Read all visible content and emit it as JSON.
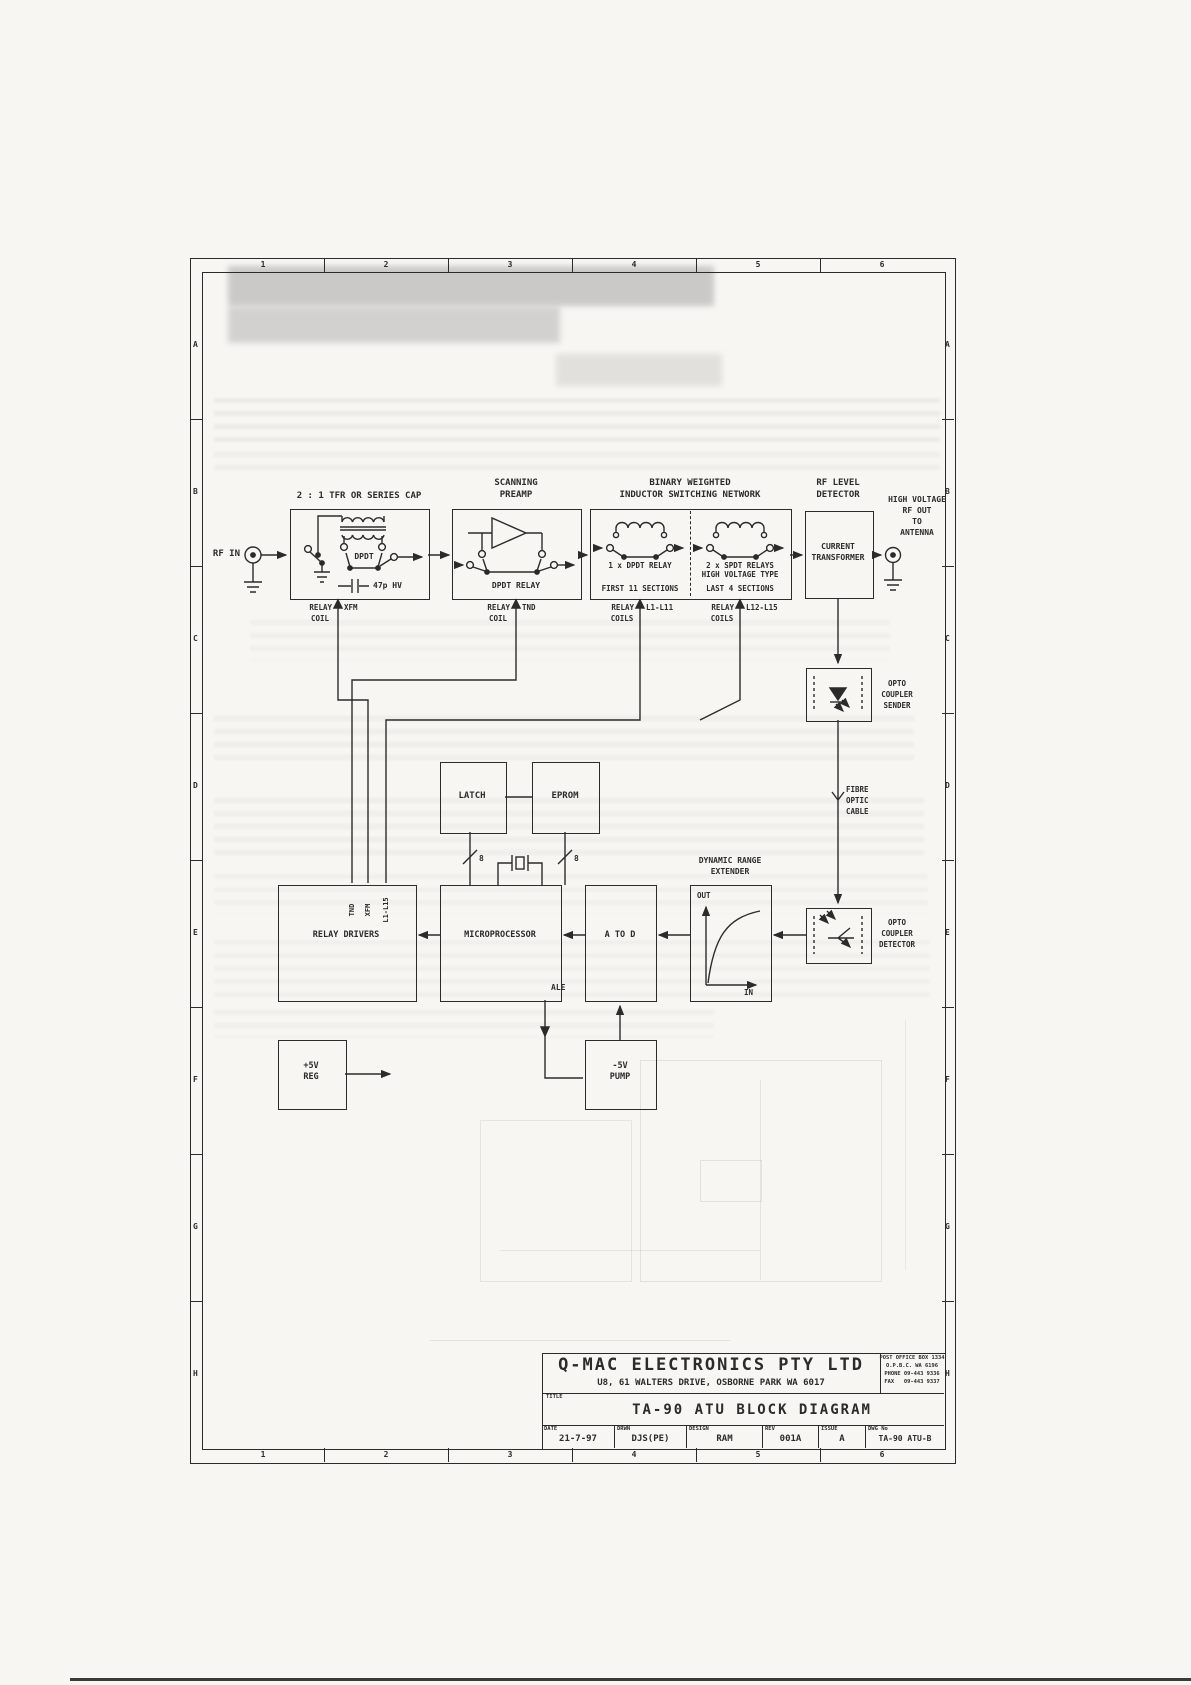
{
  "colors": {
    "ink": "#2b2b2b",
    "paper": "#f7f6f2"
  },
  "frame": {
    "columns": [
      "1",
      "2",
      "3",
      "4",
      "5",
      "6"
    ],
    "rows": [
      "A",
      "B",
      "C",
      "D",
      "E",
      "F",
      "G",
      "H"
    ]
  },
  "diagram": {
    "rf_in_label": "RF IN",
    "input_stage": {
      "title": "2 : 1 TFR OR SERIES CAP",
      "switch_label": "DPDT",
      "cap_label": "47p HV"
    },
    "preamp": {
      "title1": "SCANNING",
      "title2": "PREAMP",
      "relay_label": "DPDT RELAY"
    },
    "network": {
      "title1": "BINARY WEIGHTED",
      "title2": "INDUCTOR SWITCHING NETWORK",
      "left_relay": "1 x DPDT RELAY",
      "left_sections": "FIRST 11 SECTIONS",
      "right_relay1": "2 x SPDT RELAYS",
      "right_relay2": "HIGH VOLTAGE TYPE",
      "right_sections": "LAST 4 SECTIONS"
    },
    "detector_block": {
      "title1": "RF LEVEL",
      "title2": "DETECTOR",
      "inner1": "CURRENT",
      "inner2": "TRANSFORMER"
    },
    "rf_out": {
      "line1": "HIGH VOLTAGE",
      "line2": "RF OUT",
      "line3": "TO",
      "line4": "ANTENNA"
    },
    "coils": {
      "xfm": {
        "relay": "RELAY",
        "name": "XFM",
        "coil": "COIL"
      },
      "tnd": {
        "relay": "RELAY",
        "name": "TND",
        "coil": "COIL"
      },
      "l1": {
        "relay": "RELAY",
        "name": "L1-L11",
        "coil": "COILS"
      },
      "l12": {
        "relay": "RELAY",
        "name": "L12-L15",
        "coil": "COILS"
      }
    },
    "opto_sender": {
      "l1": "OPTO",
      "l2": "COUPLER",
      "l3": "SENDER"
    },
    "fibre": {
      "l1": "FIBRE",
      "l2": "OPTIC",
      "l3": "CABLE"
    },
    "opto_detector": {
      "l1": "OPTO",
      "l2": "COUPLER",
      "l3": "DETECTOR"
    },
    "latch_label": "LATCH",
    "eprom_label": "EPROM",
    "bus_width": "8",
    "dre": {
      "title1": "DYNAMIC RANGE",
      "title2": "EXTENDER",
      "axis_y": "OUT",
      "axis_x": "IN"
    },
    "micro_label": "MICROPROCESSOR",
    "ale_label": "ALE",
    "atod_label": "A TO D",
    "drivers": {
      "label": "RELAY DRIVERS",
      "inputs": [
        "TND",
        "XFM",
        "L1-L15"
      ]
    },
    "reg": {
      "l1": "+5V",
      "l2": "REG"
    },
    "pump": {
      "l1": "-5V",
      "l2": "PUMP"
    }
  },
  "title_block": {
    "company": "Q-MAC ELECTRONICS PTY LTD",
    "address": "U8, 61 WALTERS DRIVE, OSBORNE PARK WA 6017",
    "po_line1": "POST OFFICE BOX 1334",
    "po_line2": "O.P.B.C. WA 6196",
    "po_line3": "PHONE 09-443 9336",
    "po_line4": "FAX   09-443 9337",
    "title_label": "TITLE",
    "title": "TA-90 ATU BLOCK DIAGRAM",
    "fields": [
      {
        "label": "DATE",
        "value": "21-7-97"
      },
      {
        "label": "DRWN",
        "value": "DJS(PE)"
      },
      {
        "label": "DESIGN",
        "value": "RAM"
      },
      {
        "label": "REV",
        "value": "001A"
      },
      {
        "label": "ISSUE",
        "value": "A"
      },
      {
        "label": "DWG No",
        "value": "TA-90 ATU-B"
      }
    ]
  }
}
